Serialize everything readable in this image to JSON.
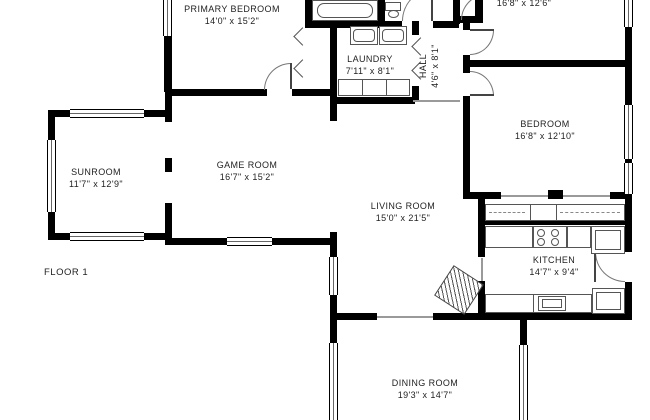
{
  "floor_label": "FLOOR 1",
  "rooms": {
    "primary_bedroom": {
      "name": "PRIMARY BEDROOM",
      "dims": "14'0\" x 15'2\""
    },
    "room_top_right": {
      "dims": "16'8\" x 12'6\""
    },
    "laundry": {
      "name": "LAUNDRY",
      "dims": "7'11\" x 8'1\""
    },
    "hall": {
      "name": "HALL",
      "dims": "4'6\" x 8'1\""
    },
    "bedroom": {
      "name": "BEDROOM",
      "dims": "16'8\" x 12'10\""
    },
    "sunroom": {
      "name": "SUNROOM",
      "dims": "11'7\" x 12'9\""
    },
    "game_room": {
      "name": "GAME ROOM",
      "dims": "16'7\" x 15'2\""
    },
    "living_room": {
      "name": "LIVING ROOM",
      "dims": "15'0\" x 21'5\""
    },
    "kitchen": {
      "name": "KITCHEN",
      "dims": "14'7\" x 9'4\""
    },
    "dining_room": {
      "name": "DINING ROOM",
      "dims": "19'3\" x 14'7\""
    }
  },
  "colors": {
    "wall": "#000000",
    "window_line": "#666666",
    "text": "#1f1f1f",
    "background": "#ffffff"
  }
}
